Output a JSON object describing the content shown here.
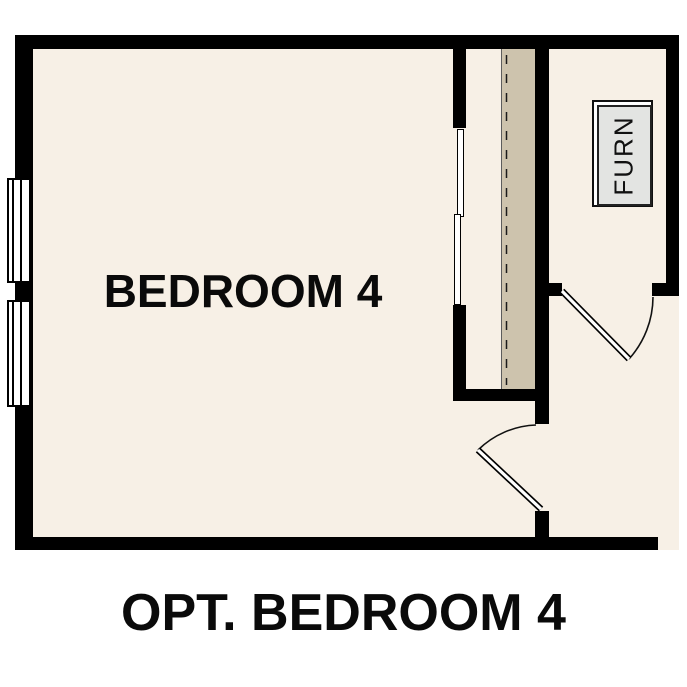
{
  "plan": {
    "caption": "OPT. BEDROOM 4",
    "rooms": [
      {
        "label": "BEDROOM 4"
      }
    ],
    "equipment": [
      {
        "label": "FURN"
      }
    ],
    "features": {
      "windows": 2,
      "closet_sliding_panels": 2,
      "swing_doors": 2
    },
    "colors": {
      "wall": "#000000",
      "floor": "#f7f0e6",
      "closet_shelf": "#cdc3ad",
      "furnace_fill": "#e3e4e2",
      "label_text": "#0a0a0a",
      "page_background": "#ffffff"
    }
  }
}
